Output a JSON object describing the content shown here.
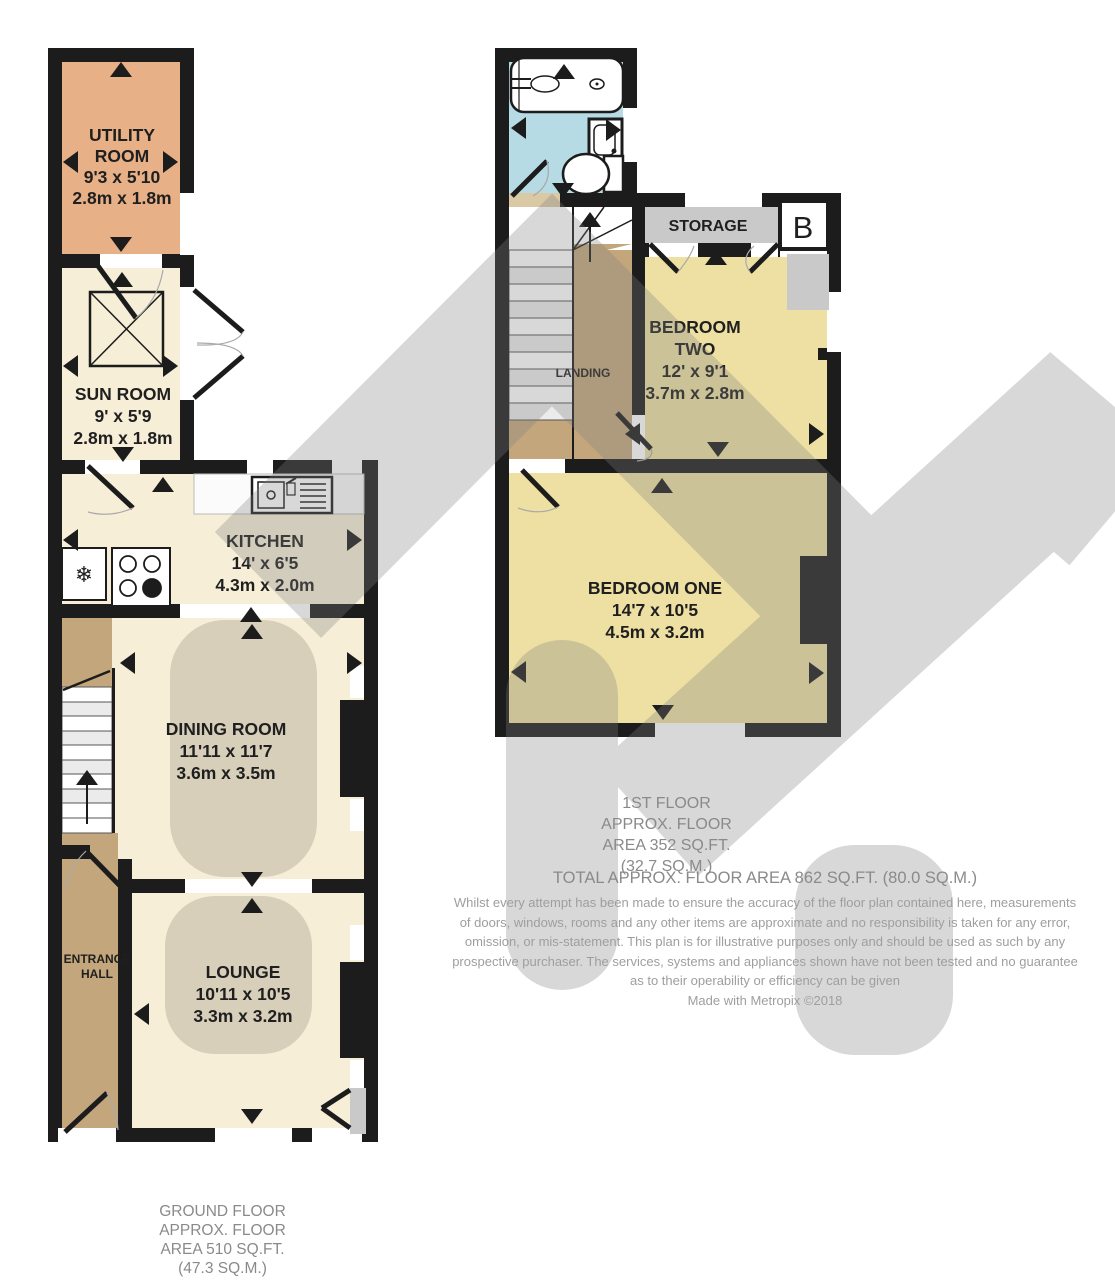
{
  "palette": {
    "wall": "#1c1c1c",
    "cream_room": "#f7eed8",
    "utility_orange": "#e8b087",
    "bedroom_yellow": "#eee0a2",
    "hall_tan": "#c3a67b",
    "bathroom_blue": "#b7dbe4",
    "rug_beige": "#d8cfba",
    "storage_gray": "#c9c9c9",
    "watermark_gray": "#7f7f7f",
    "label_text": "#1f1f1f",
    "caption_text": "#8a8a8a",
    "disclaimer_text": "#9e9e9e"
  },
  "icons": {
    "fridge_glyph": "❄"
  },
  "ground_floor": {
    "rooms": {
      "utility_room": {
        "name_lines": [
          "UTILITY",
          "ROOM"
        ],
        "imperial": "9'3 x 5'10",
        "metric": "2.8m x 1.8m"
      },
      "sun_room": {
        "name_lines": [
          "SUN ROOM"
        ],
        "imperial": "9' x 5'9",
        "metric": "2.8m x 1.8m"
      },
      "kitchen": {
        "name_lines": [
          "KITCHEN"
        ],
        "imperial": "14' x 6'5",
        "metric": "4.3m x 2.0m"
      },
      "dining_room": {
        "name_lines": [
          "DINING ROOM"
        ],
        "imperial": "11'11 x 11'7",
        "metric": "3.6m x 3.5m"
      },
      "entrance_hall": {
        "name_lines": [
          "ENTRANCE",
          "HALL"
        ]
      },
      "lounge": {
        "name_lines": [
          "LOUNGE"
        ],
        "imperial": "10'11 x 10'5",
        "metric": "3.3m x 3.2m"
      }
    },
    "caption_lines": [
      "GROUND FLOOR",
      "APPROX. FLOOR",
      "AREA 510 SQ.FT.",
      "(47.3 SQ.M.)"
    ]
  },
  "first_floor": {
    "rooms": {
      "storage": {
        "name_lines": [
          "STORAGE"
        ]
      },
      "landing": {
        "name_lines": [
          "LANDING"
        ]
      },
      "bedroom_two": {
        "name_lines": [
          "BEDROOM",
          "TWO"
        ],
        "imperial": "12' x 9'1",
        "metric": "3.7m x 2.8m"
      },
      "bedroom_one": {
        "name_lines": [
          "BEDROOM ONE"
        ],
        "imperial": "14'7 x 10'5",
        "metric": "4.5m x 3.2m"
      }
    },
    "boiler_label": "B",
    "caption_lines": [
      "1ST FLOOR",
      "APPROX. FLOOR",
      "AREA 352 SQ.FT.",
      "(32.7 SQ.M.)"
    ]
  },
  "total_area_text": "TOTAL APPROX. FLOOR AREA 862 SQ.FT. (80.0 SQ.M.)",
  "disclaimer_lines": [
    "Whilst every attempt has been made to ensure the accuracy of the floor plan contained here, measurements",
    "of doors, windows, rooms and any other items are approximate and no responsibility is taken for any error,",
    "omission, or mis-statement. This plan is for illustrative purposes only and should be used as such by any",
    "prospective purchaser. The services, systems and appliances shown have not been tested and no guarantee",
    "as to their operability or efficiency can be given"
  ],
  "credit": "Made with Metropix ©2018"
}
